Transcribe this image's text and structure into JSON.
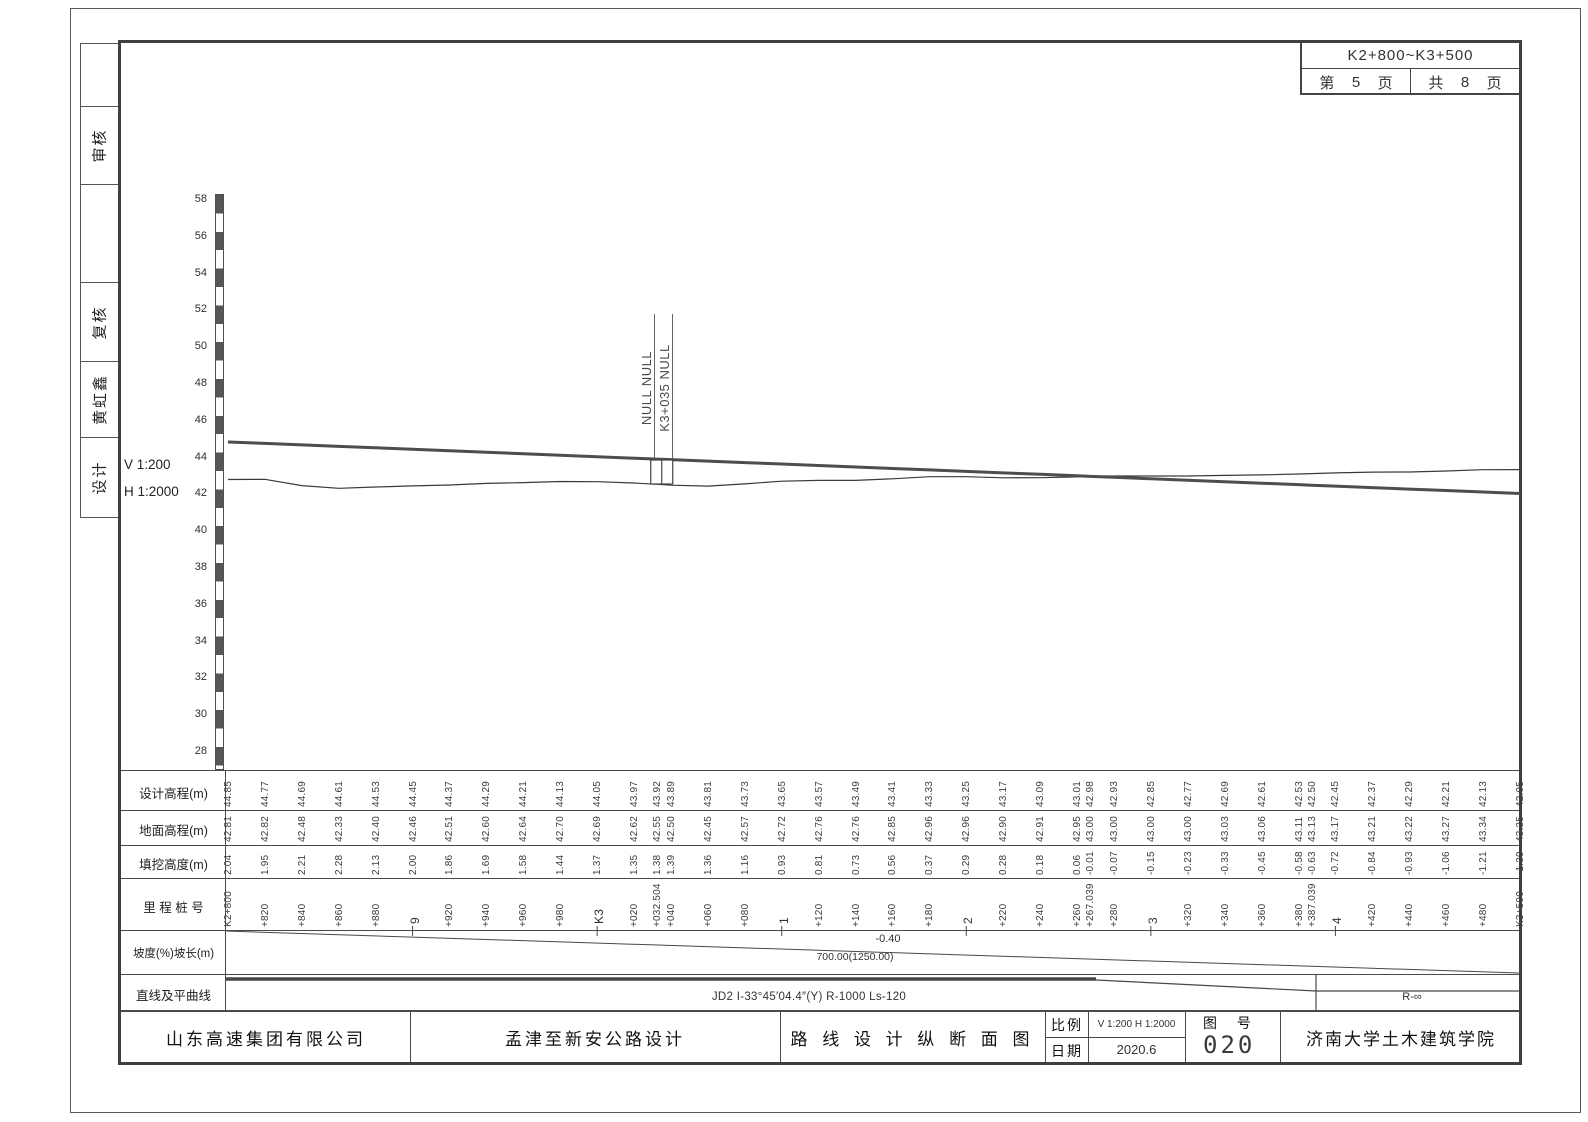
{
  "header_box": {
    "station_range": "K2+800~K3+500",
    "page_prefix": "第",
    "page_number": "5",
    "page_suffix": "页",
    "total_prefix": "共",
    "total_number": "8",
    "total_suffix": "页"
  },
  "sidebar": {
    "cells": [
      {
        "label": ""
      },
      {
        "label": "审核"
      },
      {
        "label": ""
      },
      {
        "label": "复核"
      },
      {
        "label": "黄虹鑫"
      },
      {
        "label": "设计"
      }
    ]
  },
  "scale_labels": {
    "vertical": "V 1:200",
    "horizontal": "H 1:2000"
  },
  "annotation": {
    "line1": "NULL NULL",
    "line2": "K3+035 NULL"
  },
  "profile_table": {
    "row_labels": [
      "设计高程(m)",
      "地面高程(m)",
      "填挖高度(m)",
      "里 程 桩 号",
      "坡度(%)坡长(m)",
      "直线及平曲线"
    ]
  },
  "slope": {
    "grade": "-0.40",
    "length": "700.00(1250.00)"
  },
  "alignment": {
    "curve": "JD2 I-33°45′04.4″(Y) R-1000 Ls-120",
    "tangent": "R-∞"
  },
  "title_block": {
    "company": "山东高速集团有限公司",
    "project": "孟津至新安公路设计",
    "drawing_title": "路 线 设 计 纵 断 面 图",
    "scale_label": "比例",
    "scale_value": "V 1:200 H 1:2000",
    "date_label": "日期",
    "date_value": "2020.6",
    "figure_label": "图  号",
    "figure_number": "020",
    "institute": "济南大学土木建筑学院"
  },
  "chart_data": {
    "type": "line",
    "title": "路线设计纵断面图",
    "y_axis": {
      "min": 28,
      "max": 58,
      "step": 2,
      "unit": "m"
    },
    "x_range": {
      "from": "K2+800",
      "to": "K3+500",
      "length_m": 700
    },
    "grade_percent": -0.4,
    "series_fields": [
      "design",
      "ground"
    ],
    "series_names": [
      "设计高程(m)",
      "地面高程(m)"
    ],
    "stations": [
      {
        "m": 0,
        "label": "K2+800",
        "design": "44.85",
        "ground": "42.81",
        "fill": "2.04"
      },
      {
        "m": 20,
        "label": "+820",
        "design": "44.77",
        "ground": "42.82",
        "fill": "1.95"
      },
      {
        "m": 40,
        "label": "+840",
        "design": "44.69",
        "ground": "42.48",
        "fill": "2.21"
      },
      {
        "m": 60,
        "label": "+860",
        "design": "44.61",
        "ground": "42.33",
        "fill": "2.28"
      },
      {
        "m": 80,
        "label": "+880",
        "design": "44.53",
        "ground": "42.40",
        "fill": "2.13"
      },
      {
        "m": 100,
        "label": "9",
        "major": true,
        "design": "44.45",
        "ground": "42.46",
        "fill": "2.00"
      },
      {
        "m": 120,
        "label": "+920",
        "design": "44.37",
        "ground": "42.51",
        "fill": "1.86"
      },
      {
        "m": 140,
        "label": "+940",
        "design": "44.29",
        "ground": "42.60",
        "fill": "1.69"
      },
      {
        "m": 160,
        "label": "+960",
        "design": "44.21",
        "ground": "42.64",
        "fill": "1.58"
      },
      {
        "m": 180,
        "label": "+980",
        "design": "44.13",
        "ground": "42.70",
        "fill": "1.44"
      },
      {
        "m": 200,
        "label": "K3",
        "major": true,
        "design": "44.05",
        "ground": "42.69",
        "fill": "1.37"
      },
      {
        "m": 220,
        "label": "+020",
        "design": "43.97",
        "ground": "42.62",
        "fill": "1.35"
      },
      {
        "m": 232.504,
        "label": "+032.504",
        "design": "43.92",
        "ground": "42.55",
        "fill": "1.38"
      },
      {
        "m": 240,
        "label": "+040",
        "design": "43.89",
        "ground": "42.50",
        "fill": "1.39"
      },
      {
        "m": 260,
        "label": "+060",
        "design": "43.81",
        "ground": "42.45",
        "fill": "1.36"
      },
      {
        "m": 280,
        "label": "+080",
        "design": "43.73",
        "ground": "42.57",
        "fill": "1.16"
      },
      {
        "m": 300,
        "label": "1",
        "major": true,
        "design": "43.65",
        "ground": "42.72",
        "fill": "0.93"
      },
      {
        "m": 320,
        "label": "+120",
        "design": "43.57",
        "ground": "42.76",
        "fill": "0.81"
      },
      {
        "m": 340,
        "label": "+140",
        "design": "43.49",
        "ground": "42.76",
        "fill": "0.73"
      },
      {
        "m": 360,
        "label": "+160",
        "design": "43.41",
        "ground": "42.85",
        "fill": "0.56"
      },
      {
        "m": 380,
        "label": "+180",
        "design": "43.33",
        "ground": "42.96",
        "fill": "0.37"
      },
      {
        "m": 400,
        "label": "2",
        "major": true,
        "design": "43.25",
        "ground": "42.96",
        "fill": "0.29"
      },
      {
        "m": 420,
        "label": "+220",
        "design": "43.17",
        "ground": "42.90",
        "fill": "0.28"
      },
      {
        "m": 440,
        "label": "+240",
        "design": "43.09",
        "ground": "42.91",
        "fill": "0.18"
      },
      {
        "m": 460,
        "label": "+260",
        "design": "43.01",
        "ground": "42.95",
        "fill": "0.06"
      },
      {
        "m": 467.039,
        "label": "+267.039",
        "design": "42.98",
        "ground": "43.00",
        "fill": "-0.01"
      },
      {
        "m": 480,
        "label": "+280",
        "design": "42.93",
        "ground": "43.00",
        "fill": "-0.07"
      },
      {
        "m": 500,
        "label": "3",
        "major": true,
        "design": "42.85",
        "ground": "43.00",
        "fill": "-0.15"
      },
      {
        "m": 520,
        "label": "+320",
        "design": "42.77",
        "ground": "43.00",
        "fill": "-0.23"
      },
      {
        "m": 540,
        "label": "+340",
        "design": "42.69",
        "ground": "43.03",
        "fill": "-0.33"
      },
      {
        "m": 560,
        "label": "+360",
        "design": "42.61",
        "ground": "43.06",
        "fill": "-0.45"
      },
      {
        "m": 580,
        "label": "+380",
        "design": "42.53",
        "ground": "43.11",
        "fill": "-0.58"
      },
      {
        "m": 587.039,
        "label": "+387.039",
        "design": "42.50",
        "ground": "43.13",
        "fill": "-0.63"
      },
      {
        "m": 600,
        "label": "4",
        "major": true,
        "design": "42.45",
        "ground": "43.17",
        "fill": "-0.72"
      },
      {
        "m": 620,
        "label": "+420",
        "design": "42.37",
        "ground": "43.21",
        "fill": "-0.84"
      },
      {
        "m": 640,
        "label": "+440",
        "design": "42.29",
        "ground": "43.22",
        "fill": "-0.93"
      },
      {
        "m": 660,
        "label": "+460",
        "design": "42.21",
        "ground": "43.27",
        "fill": "-1.06"
      },
      {
        "m": 680,
        "label": "+480",
        "design": "42.13",
        "ground": "43.34",
        "fill": "-1.21"
      },
      {
        "m": 700,
        "label": "K3+500",
        "design": "42.05",
        "ground": "43.35",
        "fill": "-1.30"
      }
    ]
  }
}
